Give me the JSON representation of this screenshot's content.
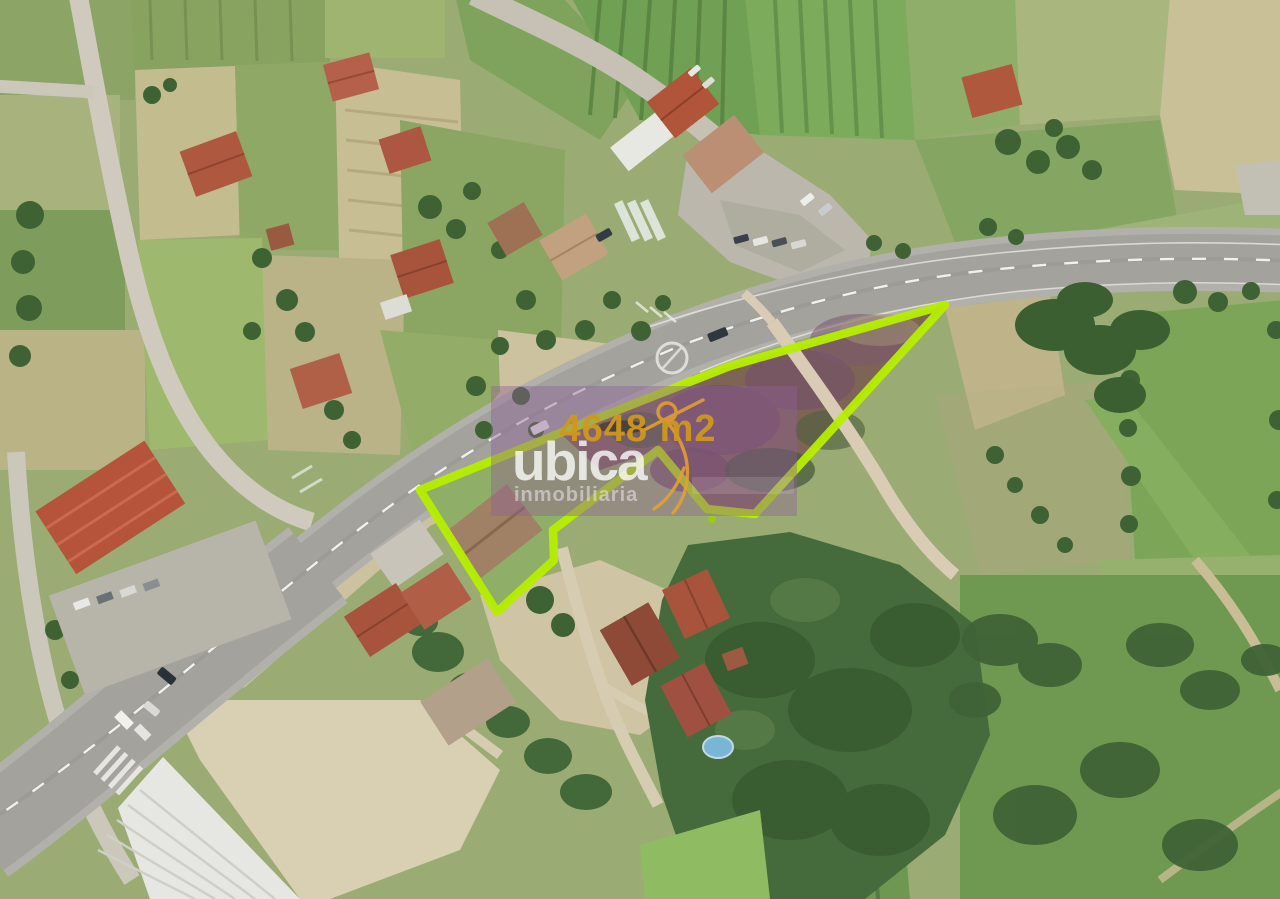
{
  "watermark": {
    "area_label": "4648 m2",
    "brand": "ubica",
    "tagline": "inmobiliaria",
    "colors": {
      "overlay_box": "#8F5F96",
      "area_text": "#D0971E",
      "brand_text": "#FFFFFF",
      "tagline_text": "#F0E4F4",
      "logo_mark": "#E8A22C"
    }
  },
  "plot": {
    "outline_color": "#B6EE00",
    "outline_points": "420,490 560,433 730,366 945,305 755,514 707,509 658,450 553,530 554,560 497,612"
  },
  "scene": {
    "kind": "aerial-orthophoto",
    "features": [
      "highway",
      "access-road",
      "rural-road",
      "farm-fields",
      "orchard-rows",
      "houses",
      "warehouse",
      "forest",
      "swimming-pool",
      "parked-cars"
    ]
  }
}
